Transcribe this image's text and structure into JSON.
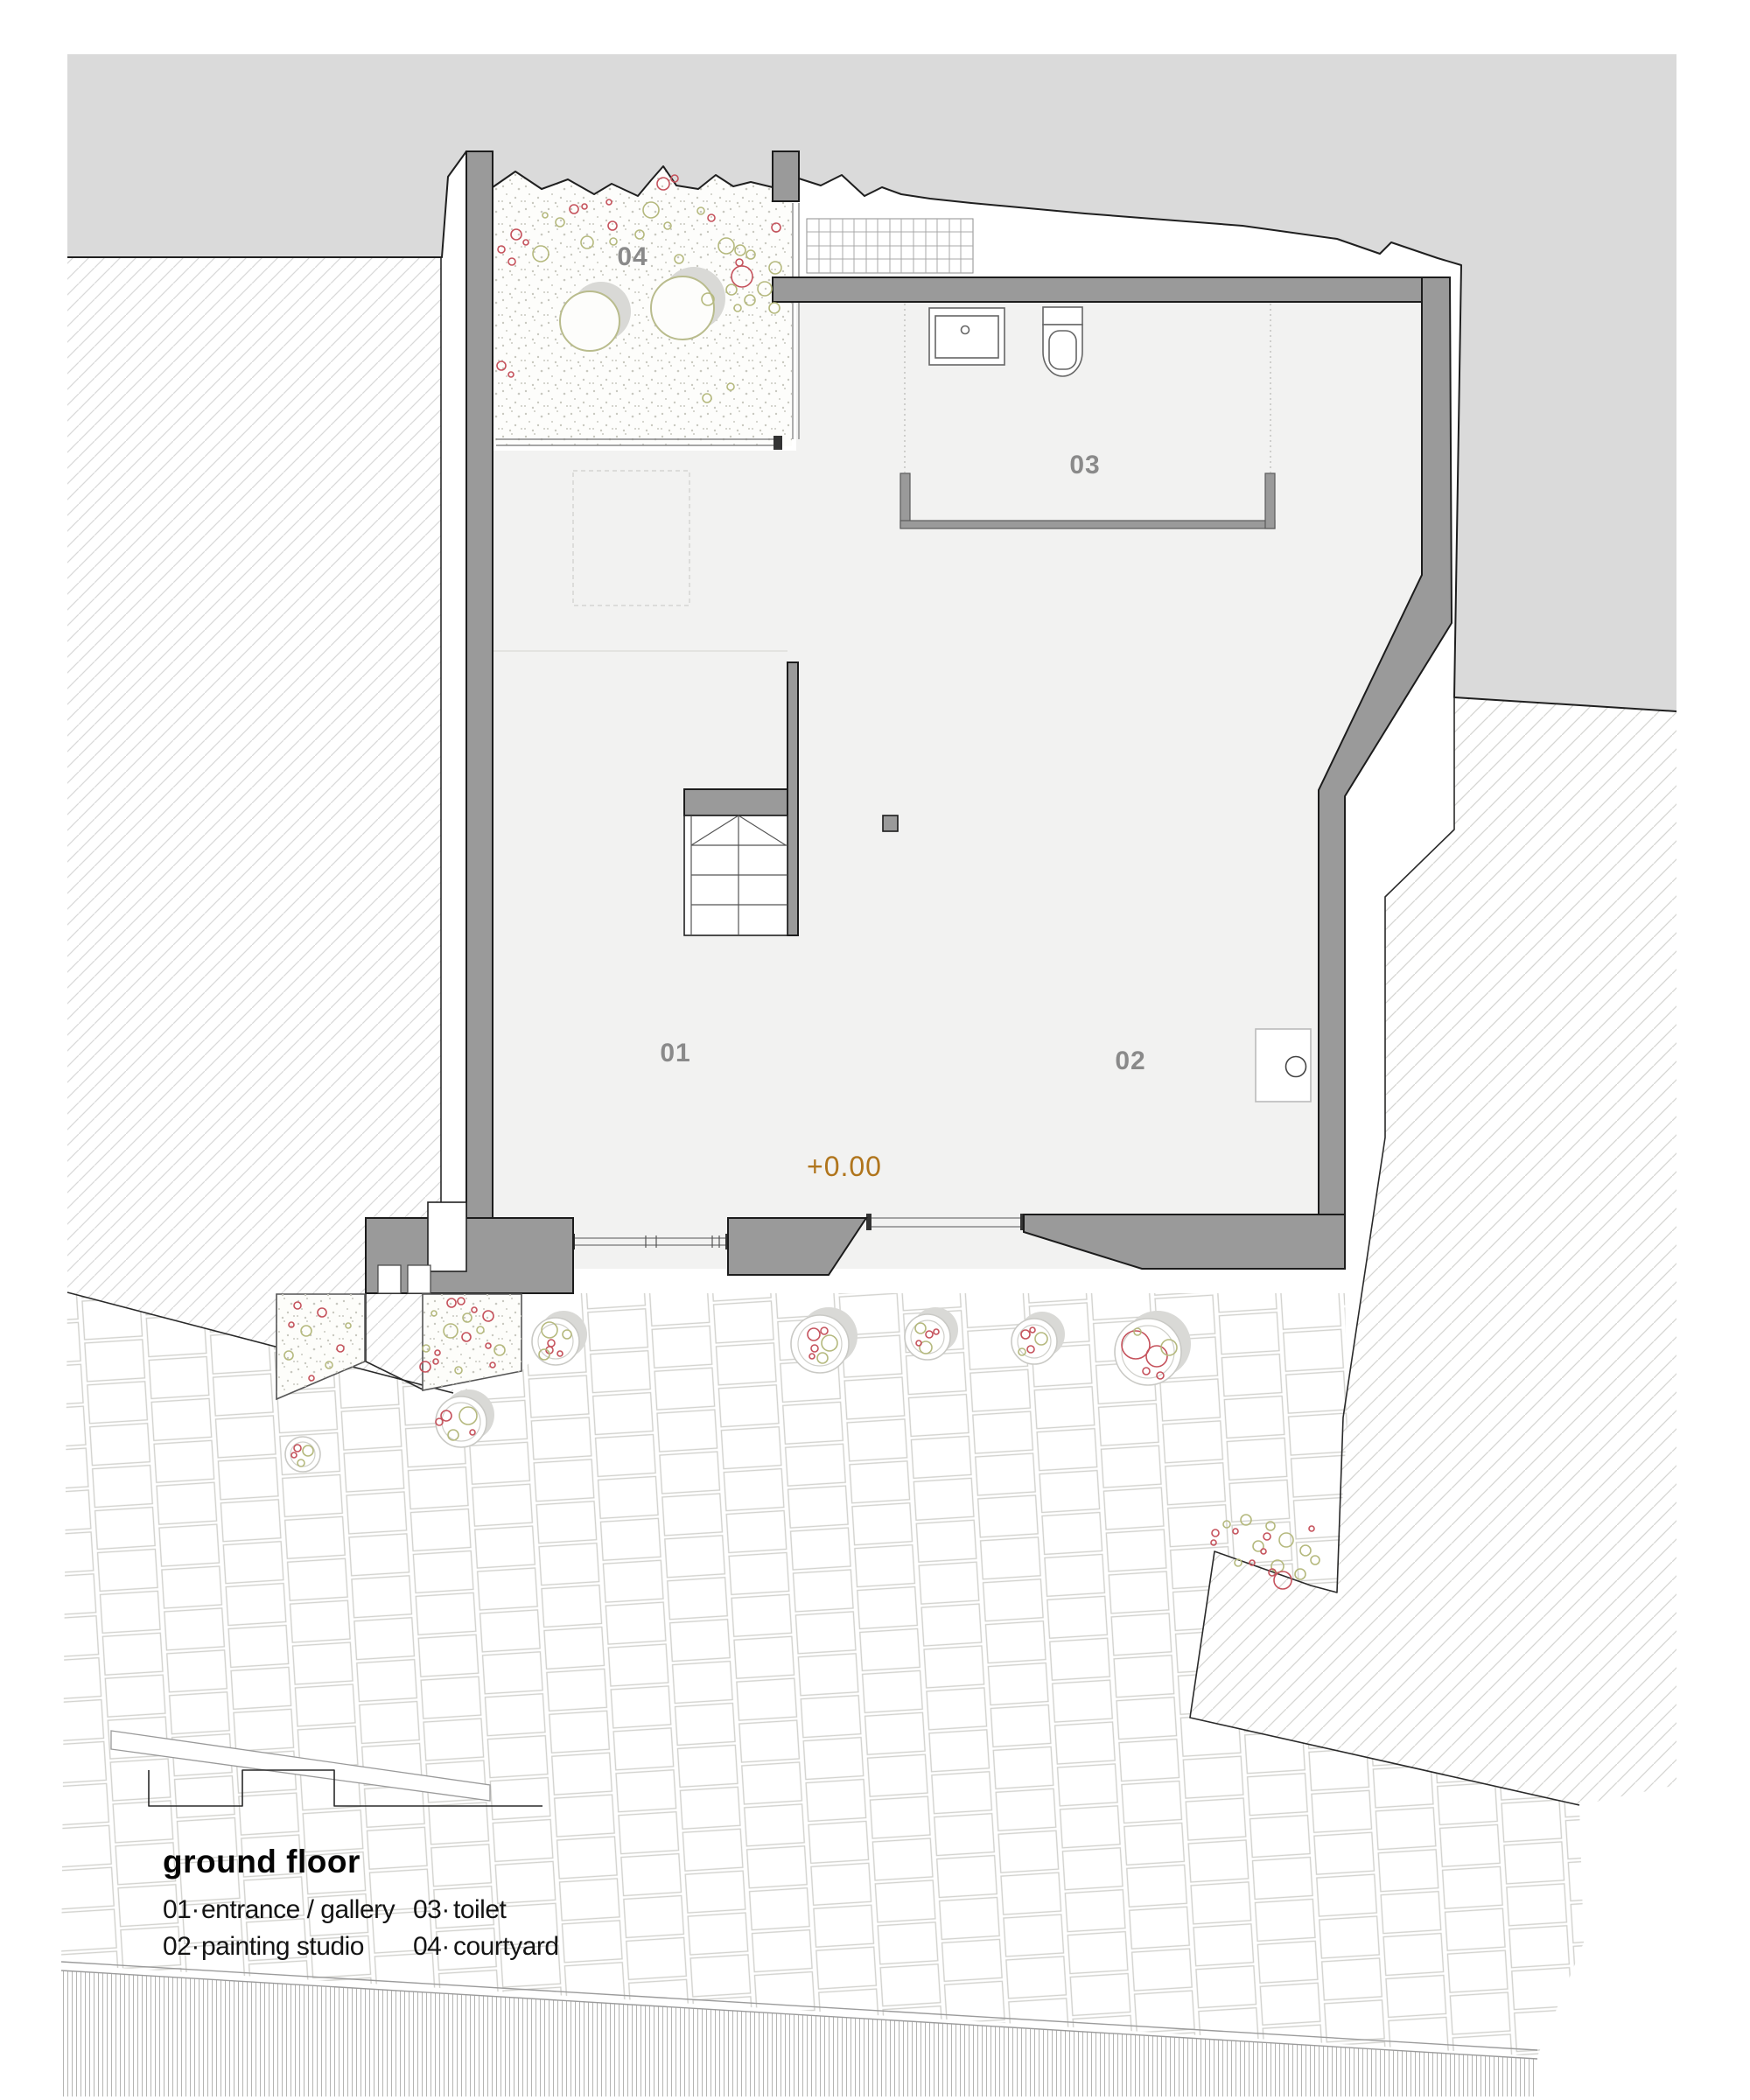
{
  "title_block": {
    "title": "ground floor",
    "legend": [
      {
        "num": "01·",
        "label": "entrance / gallery"
      },
      {
        "num": "02·",
        "label": "painting studio"
      },
      {
        "num": "03·",
        "label": "toilet"
      },
      {
        "num": "04·",
        "label": "courtyard"
      }
    ]
  },
  "plan": {
    "level_marker": "+0.00",
    "rooms": [
      {
        "label": "01"
      },
      {
        "label": "02"
      },
      {
        "label": "03"
      },
      {
        "label": "04"
      }
    ]
  },
  "colors": {
    "site_context": "#dadada",
    "wall": "#9a9a9a",
    "interior_floor": "#f2f2f1",
    "level_marker_accent": "#b0751c",
    "room_label": "#8a8a8a",
    "planting_olive": "#b5b97e",
    "planting_red": "#c5525c"
  }
}
